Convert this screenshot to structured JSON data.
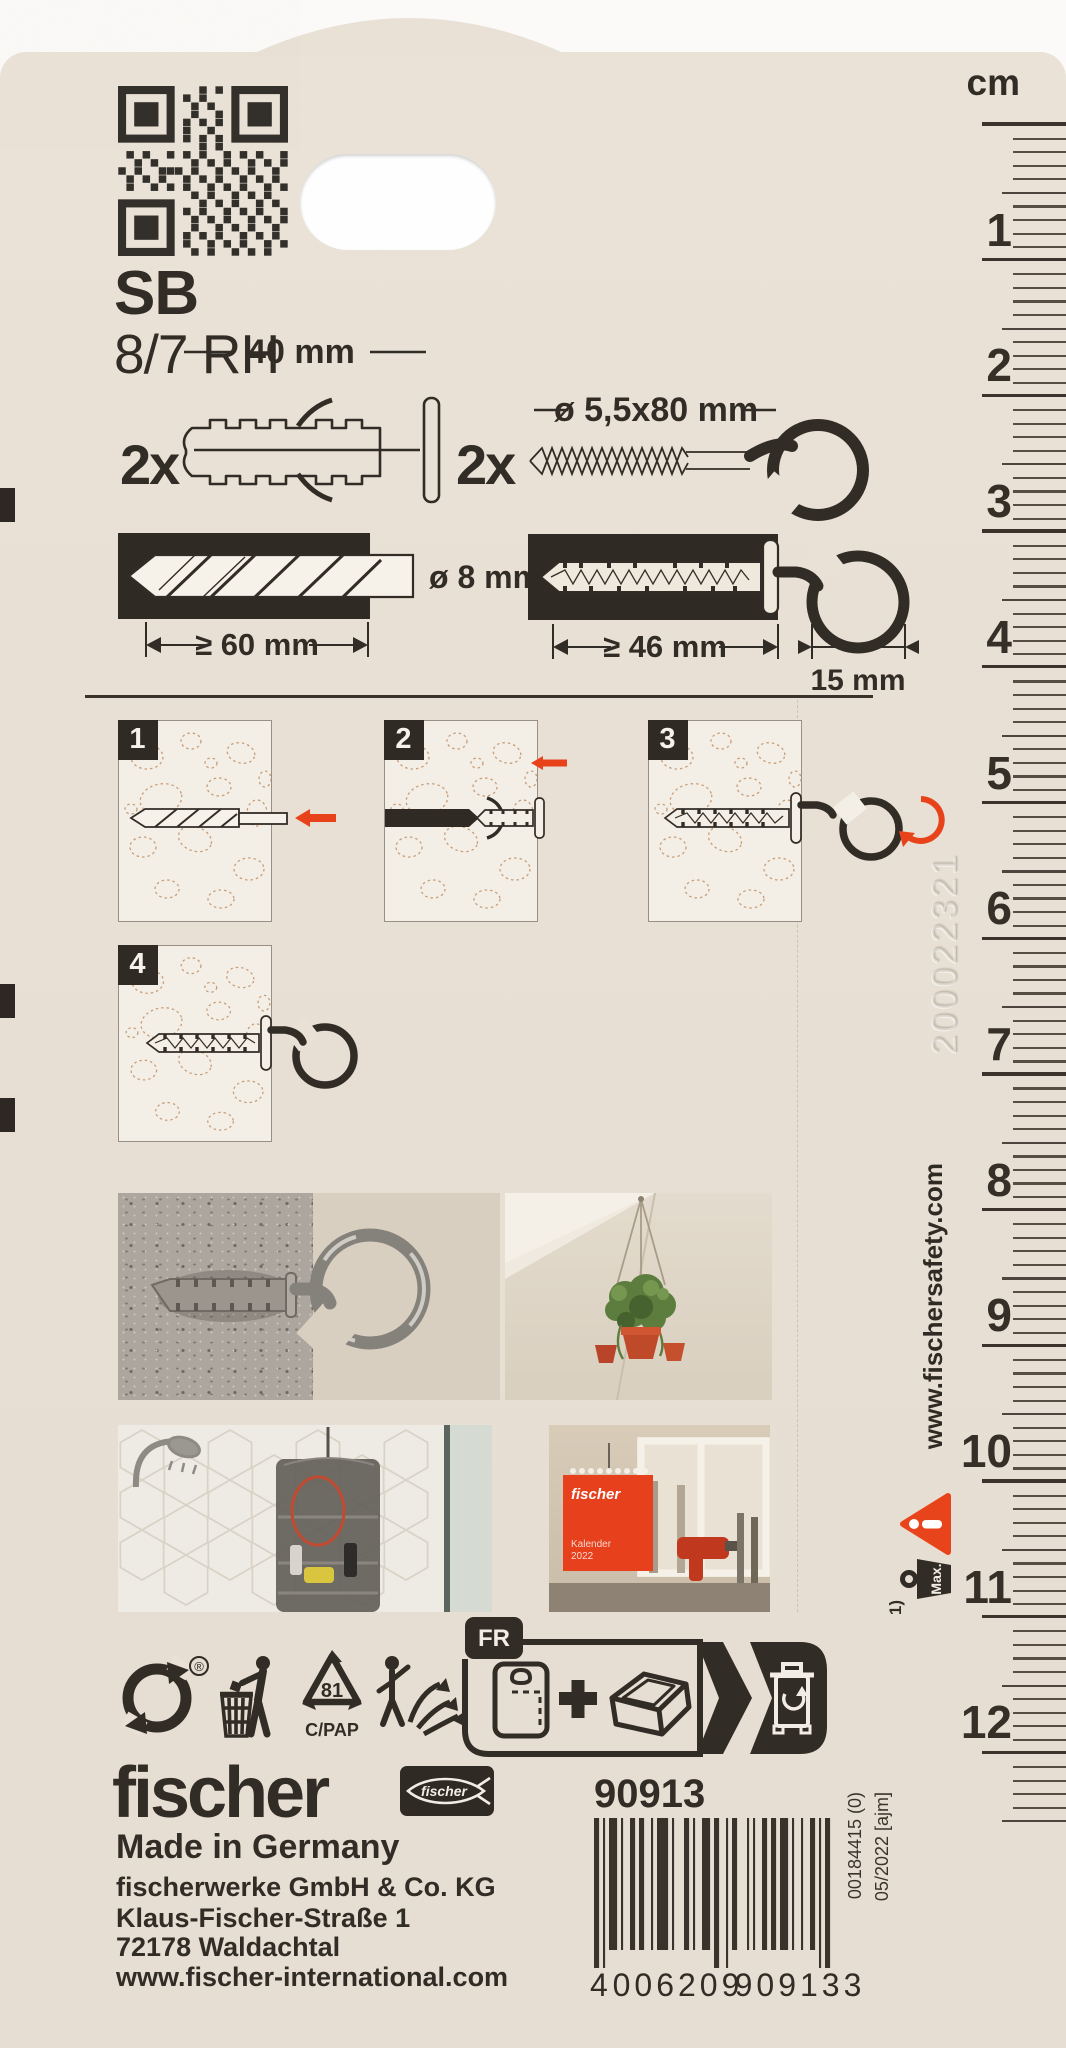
{
  "product": {
    "code": "SB",
    "variant": "8/7 RH"
  },
  "contents": {
    "plug_qty": "2x",
    "plug_length": "40 mm",
    "hook_qty": "2x",
    "hook_size": "ø 5,5x80 mm"
  },
  "installation": {
    "drill_diameter": "ø 8 mm",
    "drill_depth": "≥ 60 mm",
    "anchor_depth": "≥ 46 mm",
    "hook_width": "15 mm"
  },
  "steps": {
    "s1": "1",
    "s2": "2",
    "s3": "3",
    "s4": "4"
  },
  "ruler": {
    "unit": "cm",
    "count": 12
  },
  "side": {
    "safety_website": "www.fischersafety.com",
    "embossed_code": "200022321",
    "footnote": "1)",
    "max_label": "Max."
  },
  "recycling": {
    "registered": "®",
    "code": "81",
    "material": "C/PAP",
    "country": "FR"
  },
  "footer": {
    "brand": "fischer",
    "brand_script": "fischer",
    "made_in": "Made in Germany",
    "company": "fischerwerke GmbH & Co. KG",
    "street": "Klaus-Fischer-Straße 1",
    "city": "72178 Waldachtal",
    "website": "www.fischer-international.com",
    "article_no": "90913",
    "ean": {
      "d1": "4",
      "d2": "006209",
      "d3": "909133"
    },
    "print_ref": "00184415 (0)",
    "print_date": "05/2022 [ajm]"
  },
  "photo_calendar": {
    "brand": "fischer",
    "title": "Kalender",
    "year": "2022"
  },
  "colors": {
    "card": "#e9e1d5",
    "ink": "#322c26",
    "accent_red": "#e8421b"
  }
}
